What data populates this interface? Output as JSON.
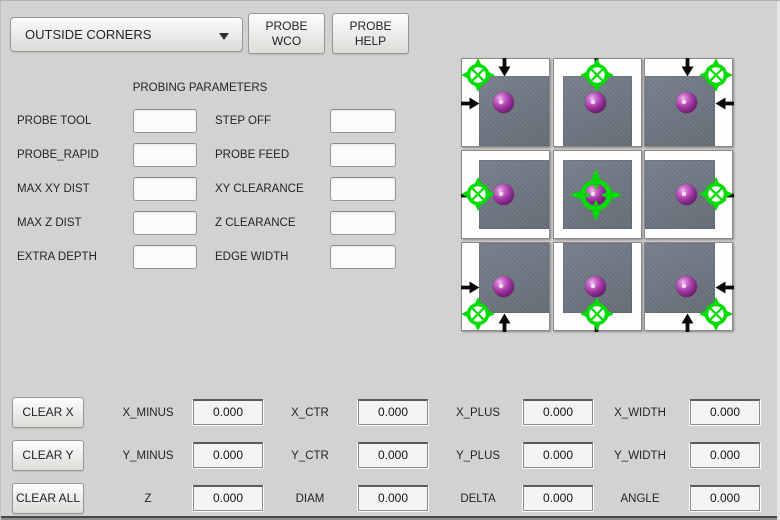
{
  "header": {
    "mode_dropdown": {
      "selected": "OUTSIDE CORNERS"
    },
    "probe_wco_button": {
      "line1": "PROBE",
      "line2": "WCO"
    },
    "probe_help_button": {
      "line1": "PROBE",
      "line2": "HELP"
    }
  },
  "parameters": {
    "title": "PROBING PARAMETERS",
    "rows": [
      {
        "left": {
          "label": "PROBE TOOL",
          "value": "",
          "placeholder": ""
        },
        "right": {
          "label": "STEP OFF",
          "value": "",
          "placeholder": ""
        }
      },
      {
        "left": {
          "label": "PROBE_RAPID",
          "value": "",
          "placeholder": ""
        },
        "right": {
          "label": "PROBE FEED",
          "value": "",
          "placeholder": ""
        }
      },
      {
        "left": {
          "label": "MAX XY DIST",
          "value": "",
          "placeholder": ""
        },
        "right": {
          "label": "XY CLEARANCE",
          "value": "",
          "placeholder": ""
        }
      },
      {
        "left": {
          "label": "MAX Z DIST",
          "value": "",
          "placeholder": ""
        },
        "right": {
          "label": "Z CLEARANCE",
          "value": "",
          "placeholder": ""
        }
      },
      {
        "left": {
          "label": "EXTRA DEPTH",
          "value": "",
          "placeholder": ""
        },
        "right": {
          "label": "EDGE WIDTH",
          "value": "",
          "placeholder": ""
        }
      }
    ]
  },
  "probe_grid": {
    "cells": [
      {
        "name": "probe-top-left-corner",
        "icons": [
          "crosshair-icon",
          "arrow-down-icon",
          "arrow-right-icon",
          "probe-ball-icon"
        ]
      },
      {
        "name": "probe-top-edge",
        "icons": [
          "crosshair-icon",
          "arrow-down-icon",
          "probe-ball-icon"
        ]
      },
      {
        "name": "probe-top-right-corner",
        "icons": [
          "crosshair-icon",
          "arrow-down-icon",
          "arrow-left-icon",
          "probe-ball-icon"
        ]
      },
      {
        "name": "probe-left-edge",
        "icons": [
          "crosshair-icon",
          "arrow-right-icon",
          "probe-ball-icon"
        ]
      },
      {
        "name": "probe-center",
        "icons": [
          "crosshair-icon",
          "probe-ball-icon"
        ]
      },
      {
        "name": "probe-right-edge",
        "icons": [
          "crosshair-icon",
          "arrow-left-icon",
          "probe-ball-icon"
        ]
      },
      {
        "name": "probe-bottom-left-corner",
        "icons": [
          "crosshair-icon",
          "arrow-up-icon",
          "arrow-right-icon",
          "probe-ball-icon"
        ]
      },
      {
        "name": "probe-bottom-edge",
        "icons": [
          "crosshair-icon",
          "arrow-up-icon",
          "probe-ball-icon"
        ]
      },
      {
        "name": "probe-bottom-right-corner",
        "icons": [
          "crosshair-icon",
          "arrow-up-icon",
          "arrow-left-icon",
          "probe-ball-icon"
        ]
      }
    ]
  },
  "results": {
    "clear_buttons": [
      {
        "label": "CLEAR X"
      },
      {
        "label": "CLEAR Y"
      },
      {
        "label": "CLEAR ALL"
      }
    ],
    "rows": [
      [
        {
          "label": "X_MINUS",
          "value": "0.000"
        },
        {
          "label": "X_CTR",
          "value": "0.000"
        },
        {
          "label": "X_PLUS",
          "value": "0.000"
        },
        {
          "label": "X_WIDTH",
          "value": "0.000"
        }
      ],
      [
        {
          "label": "Y_MINUS",
          "value": "0.000"
        },
        {
          "label": "Y_CTR",
          "value": "0.000"
        },
        {
          "label": "Y_PLUS",
          "value": "0.000"
        },
        {
          "label": "Y_WIDTH",
          "value": "0.000"
        }
      ],
      [
        {
          "label": "Z",
          "value": "0.000"
        },
        {
          "label": "DIAM",
          "value": "0.000"
        },
        {
          "label": "DELTA",
          "value": "0.000"
        },
        {
          "label": "ANGLE",
          "value": "0.000"
        }
      ]
    ]
  },
  "colors": {
    "background": "#d4d1d1",
    "accent_green": "#00dd00",
    "probe_ball": "#a238a4",
    "work_square": "#6e7580",
    "arrow_black": "#0a0a0a"
  }
}
